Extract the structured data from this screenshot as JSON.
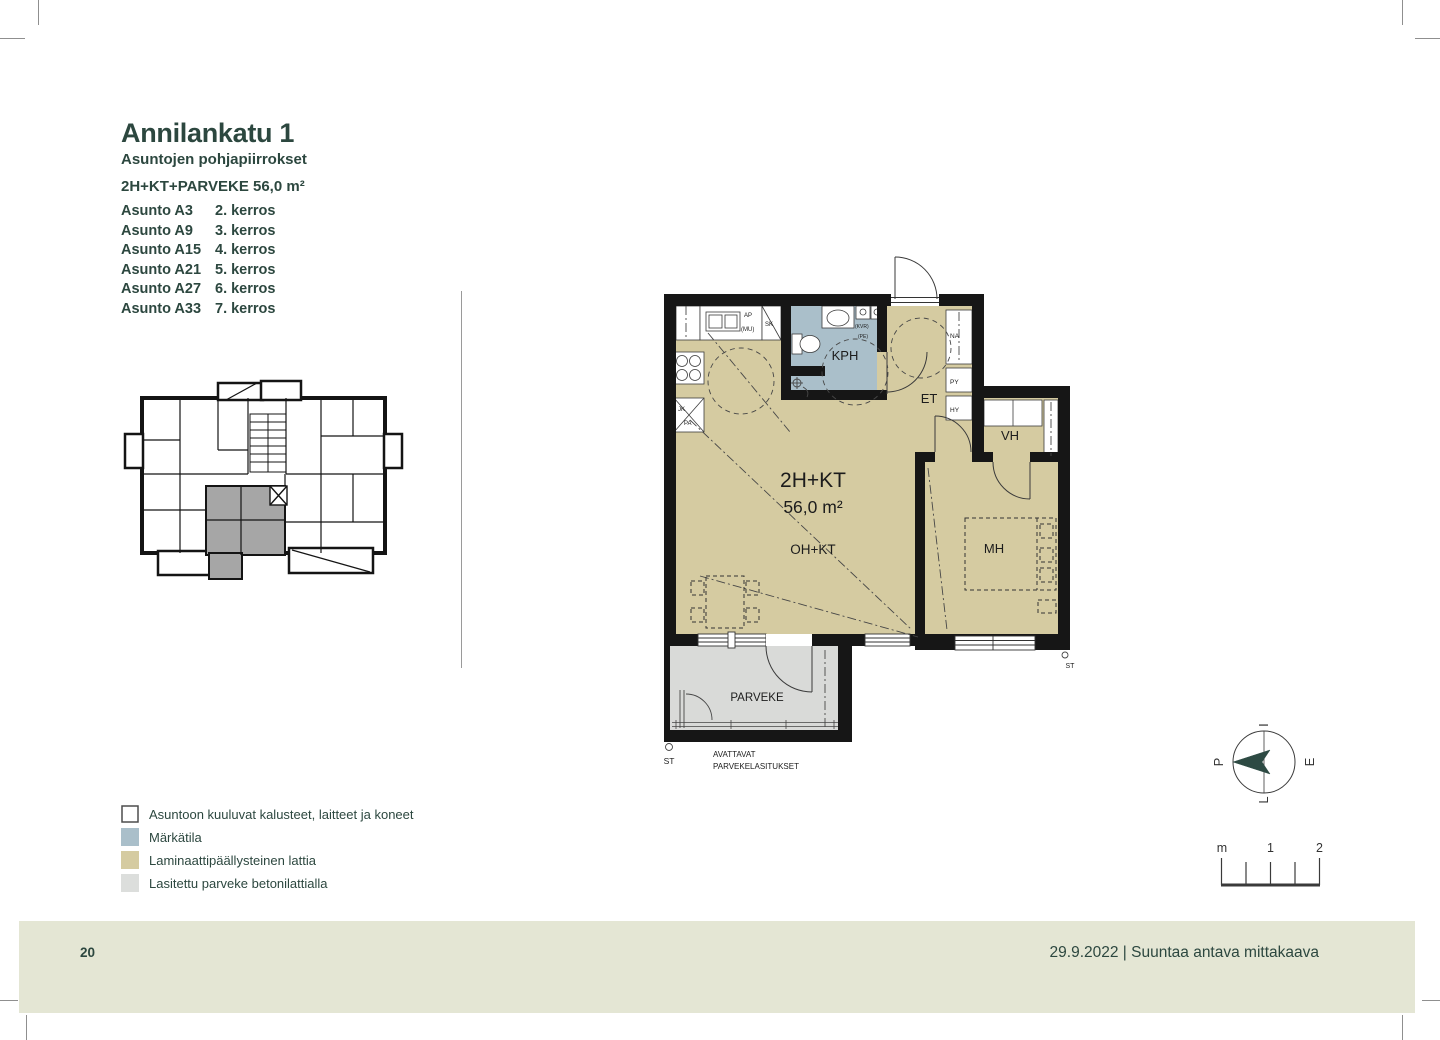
{
  "header": {
    "title": "Annilankatu 1",
    "subtitle": "Asuntojen pohjapiirrokset",
    "apartment_type": "2H+KT+PARVEKE 56,0 m²"
  },
  "apartments": [
    {
      "name": "Asunto A3",
      "floor": "2. kerros"
    },
    {
      "name": "Asunto A9",
      "floor": "3. kerros"
    },
    {
      "name": "Asunto A15",
      "floor": "4. kerros"
    },
    {
      "name": "Asunto A21",
      "floor": "5. kerros"
    },
    {
      "name": "Asunto A27",
      "floor": "6. kerros"
    },
    {
      "name": "Asunto A33",
      "floor": "7. kerros"
    }
  ],
  "plan": {
    "room_kph": "KPH",
    "room_et": "ET",
    "room_vh": "VH",
    "room_mh": "MH",
    "type_label": "2H+KT",
    "area_label": "56,0 m²",
    "living_label": "OH+KT",
    "balcony_label": "PARVEKE",
    "balcony_note1": "AVATTAVAT",
    "balcony_note2": "PARVEKELASITUKSET",
    "st_left": "ST",
    "st_right": "ST",
    "fx_ap": "AP",
    "fx_mu": "(MU)",
    "fx_sk": "SK",
    "fx_jk": "JK",
    "fx_pa": "PA",
    "fx_na": "NA",
    "fx_py": "PY",
    "fx_hy": "HY",
    "fx_kvr": "(KVR)",
    "fx_pe": "(PE)"
  },
  "legend": {
    "items": [
      {
        "label": "Asuntoon kuuluvat kalusteet, laitteet ja koneet",
        "color": "#ffffff"
      },
      {
        "label": "Märkätila",
        "color": "#aabfca"
      },
      {
        "label": "Laminaattipäällysteinen lattia",
        "color": "#d5cba1"
      },
      {
        "label": "Lasitettu parveke betonilattialla",
        "color": "#dcdedc"
      }
    ]
  },
  "compass": {
    "north": "P",
    "top": "I",
    "right": "E",
    "bottom": "L"
  },
  "scalebar": {
    "unit": "m",
    "mid": "1",
    "end": "2"
  },
  "footer": {
    "page_number": "20",
    "note": "29.9.2022 | Suuntaa antava mittakaava"
  },
  "colors": {
    "floor": "#d5cba1",
    "wet": "#aabfca",
    "balcony": "#d9dad8",
    "footer_band": "#e4e6d4",
    "accent": "#2d4a43",
    "keyplan_highlight": "#a6a6a6",
    "wall": "#161616"
  }
}
